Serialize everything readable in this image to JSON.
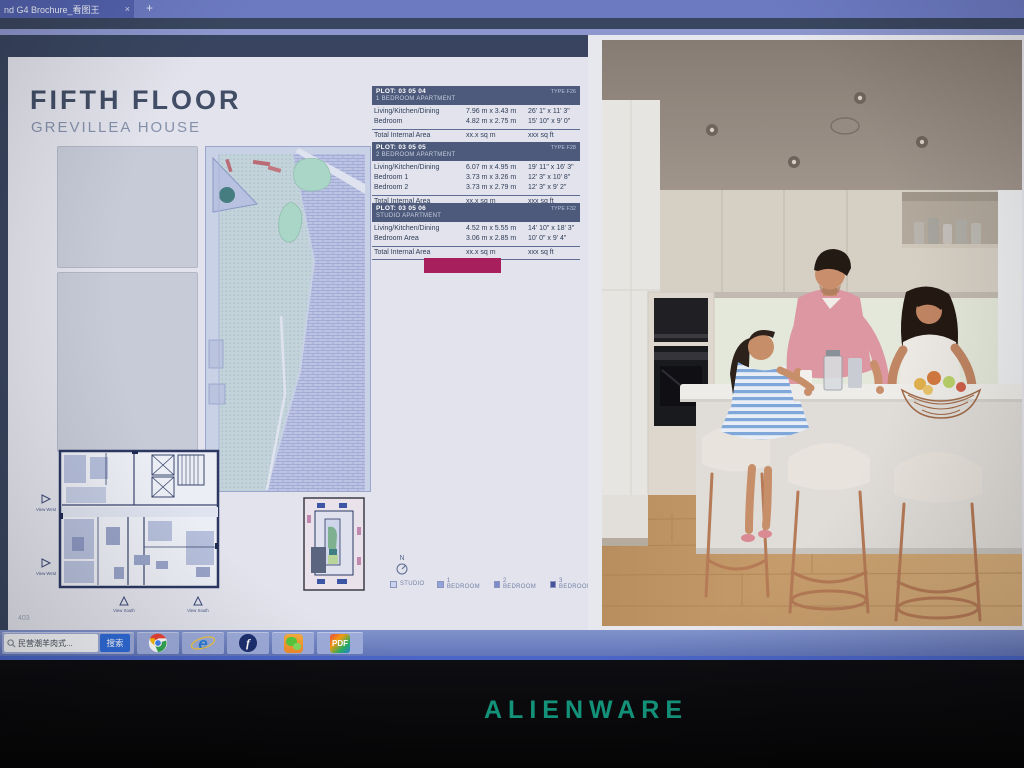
{
  "browser": {
    "tab_title": "nd G4 Brochure_看图王",
    "tab_close": "×",
    "new_tab": "+"
  },
  "doc": {
    "title": "FIFTH FLOOR",
    "subtitle": "GREVILLEA HOUSE",
    "page_number": "403",
    "compass_label": "N",
    "view_west": "View West",
    "view_south": "View South",
    "legend": [
      {
        "label": "STUDIO",
        "swatch_style": "background:#c9d2ec"
      },
      {
        "label": "1 BEDROOM",
        "swatch_style": "background:#94a2dc"
      },
      {
        "label": "2 BEDROOM",
        "swatch_style": "background:#7b8cc9"
      },
      {
        "label": "3 BEDROOM",
        "swatch_style": "background:#46549e"
      }
    ],
    "redaction_style": "background:#a81f5e"
  },
  "tables": [
    {
      "plot": "PLOT: 03 05 04",
      "type_label": "TYPE F26",
      "subtitle": "1 BEDROOM APARTMENT",
      "rows": [
        {
          "label": "Living/Kitchen/Dining",
          "metric": "7.96 m x 3.43 m",
          "imperial": "26' 1\" x 11' 3\""
        },
        {
          "label": "Bedroom",
          "metric": "4.82 m x 2.75 m",
          "imperial": "15' 10\" x 9' 0\""
        }
      ],
      "total": {
        "label": "Total Internal Area",
        "metric": "xx.x sq m",
        "imperial": "xxx sq ft"
      }
    },
    {
      "plot": "PLOT: 03 05 05",
      "type_label": "TYPE F28",
      "subtitle": "2 BEDROOM APARTMENT",
      "rows": [
        {
          "label": "Living/Kitchen/Dining",
          "metric": "6.07 m x 4.95 m",
          "imperial": "19' 11\" x 16' 3\""
        },
        {
          "label": "Bedroom 1",
          "metric": "3.73 m x 3.26 m",
          "imperial": "12' 3\" x 10' 8\""
        },
        {
          "label": "Bedroom 2",
          "metric": "3.73 m x 2.79 m",
          "imperial": "12' 3\" x 9' 2\""
        }
      ],
      "total": {
        "label": "Total Internal Area",
        "metric": "xx.x sq m",
        "imperial": "xxx sq ft"
      }
    },
    {
      "plot": "PLOT: 03 05 06",
      "type_label": "TYPE F32",
      "subtitle": "STUDIO APARTMENT",
      "rows": [
        {
          "label": "Living/Kitchen/Dining",
          "metric": "4.52 m x 5.55 m",
          "imperial": "14' 10\" x 18' 3\""
        },
        {
          "label": "Bedroom Area",
          "metric": "3.06 m x 2.85 m",
          "imperial": "10' 0\" x 9' 4\""
        }
      ],
      "total": {
        "label": "Total Internal Area",
        "metric": "xx.x sq m",
        "imperial": "xxx sq ft"
      }
    }
  ],
  "taskbar": {
    "search_text": "民营潮羊肉式...",
    "search_button": "搜索",
    "chrome": "Chrome",
    "ie": "Internet Explorer",
    "ie_label": "e",
    "flash": "Flash",
    "flash_label": "f",
    "wechat": "WeChat",
    "pdf": "PDF Reader",
    "pdf_label": "PDF"
  },
  "bezel": {
    "brand": "ALIENWARE"
  },
  "colors": {
    "brand_teal": "#14977e",
    "table_header": "#4d5a7c",
    "redaction": "#a81f5e",
    "taskbar_blue": "#7487c4",
    "page_bg": "#e2e3ec"
  }
}
